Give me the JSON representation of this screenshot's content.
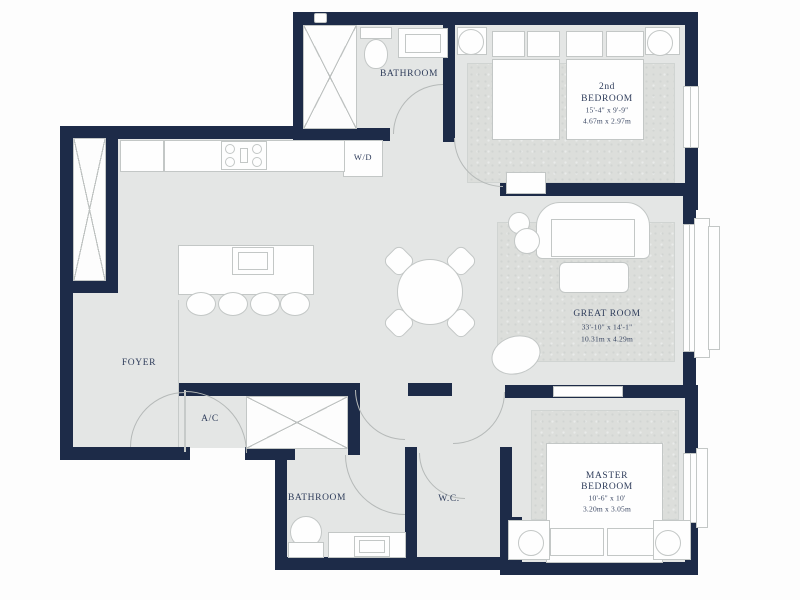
{
  "title": "Apartment floor plan",
  "colors": {
    "wall": "#1d2b48",
    "floor": "#e4e6e5",
    "carpet": "#dcdedb",
    "furniture_outline": "#c3c7c6",
    "label_text": "#2f3d5b"
  },
  "rooms": {
    "bathroom_top": {
      "name": "BATHROOM"
    },
    "laundry": {
      "name": "W/D"
    },
    "second_bedroom": {
      "line1": "2nd",
      "line2": "BEDROOM",
      "dims_ft": "15'-4\" x 9'-9\"",
      "dims_m": "4.67m x 2.97m"
    },
    "great_room": {
      "name": "GREAT ROOM",
      "dims_ft": "33'-10\" x 14'-1\"",
      "dims_m": "10.31m x 4.29m"
    },
    "foyer": {
      "name": "FOYER"
    },
    "ac": {
      "name": "A/C"
    },
    "bathroom_bottom": {
      "name": "BATHROOM"
    },
    "wc": {
      "name": "W.C."
    },
    "master_bedroom": {
      "line1": "MASTER",
      "line2": "BEDROOM",
      "dims_ft": "10'-6\" x 10'",
      "dims_m": "3.20m x 3.05m"
    }
  },
  "fixtures": [
    "shower",
    "toilet",
    "sink",
    "washer-dryer",
    "stove",
    "kitchen-island",
    "bar-stools",
    "dining-table",
    "sofa",
    "coffee-table",
    "side-tables",
    "accent-chair",
    "beds",
    "pillows",
    "nightstand-lamps",
    "closet-x",
    "windows",
    "balcony",
    "door-swings"
  ]
}
